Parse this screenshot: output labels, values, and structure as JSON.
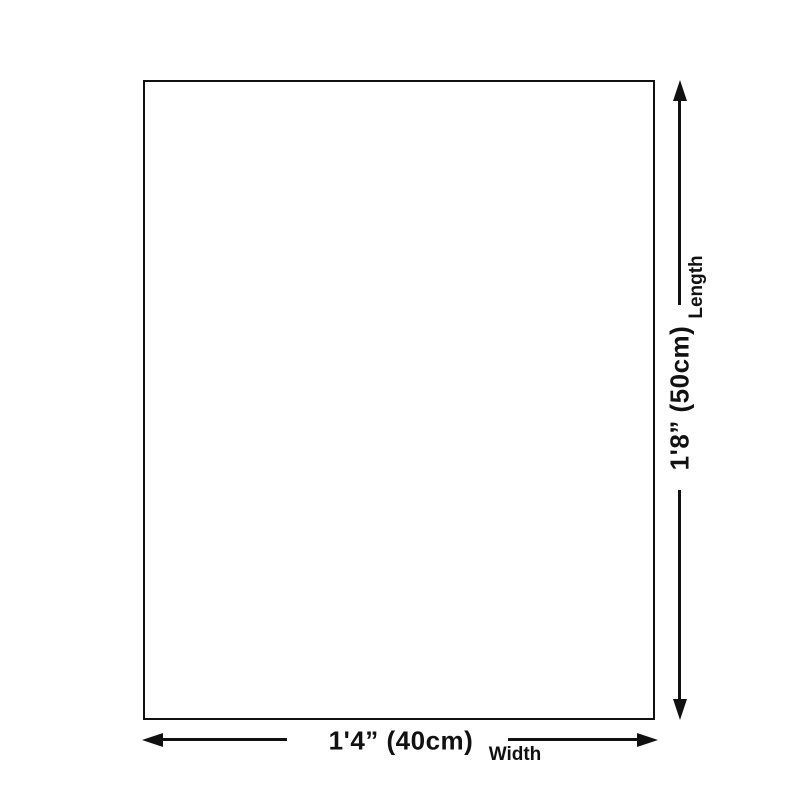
{
  "colors": {
    "ink": "#111111",
    "background": "#ffffff"
  },
  "diagram": {
    "product": {
      "shape": "blank-rectangle-outline"
    },
    "length": {
      "value": "1'8” (50cm)",
      "label": "Length"
    },
    "width": {
      "value": "1'4” (40cm)",
      "label": "Width"
    },
    "icons": {
      "vertical_arrow": "double-headed-arrow-vertical",
      "horizontal_arrow": "double-headed-arrow-horizontal"
    }
  }
}
